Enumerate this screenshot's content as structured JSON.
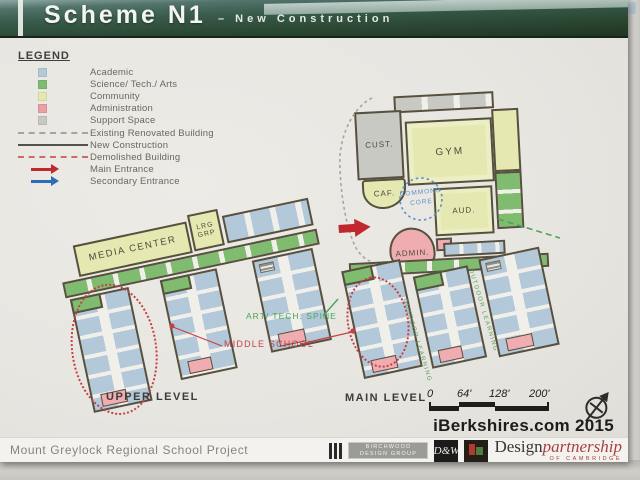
{
  "title": {
    "main": "Scheme N1",
    "subtitle": "– New Construction"
  },
  "legend": {
    "heading": "LEGEND",
    "swatches": [
      {
        "label": "Academic",
        "color": "#b3c9da"
      },
      {
        "label": "Science/ Tech./ Arts",
        "color": "#7fbc70"
      },
      {
        "label": "Community",
        "color": "#e5e8b0"
      },
      {
        "label": "Administration",
        "color": "#e9a0a4"
      },
      {
        "label": "Support Space",
        "color": "#c9c9c3"
      }
    ],
    "lines": [
      {
        "label": "Existing Renovated Building",
        "style": "dashed"
      },
      {
        "label": "New Construction",
        "style": "solid"
      },
      {
        "label": "Demolished Building",
        "style": "dashed"
      }
    ],
    "arrows": [
      {
        "label": "Main Entrance",
        "color": "#c1272d"
      },
      {
        "label": "Secondary Entrance",
        "color": "#2f6db6"
      }
    ]
  },
  "plans": {
    "upper": {
      "caption": "UPPER LEVEL",
      "media_center": "MEDIA CENTER",
      "lrg_grp": "LRG GRP"
    },
    "main": {
      "caption": "MAIN LEVEL",
      "cust": "CUST.",
      "gym": "GYM",
      "caf": "CAF.",
      "commons_line1": "COMMONS",
      "commons_line2": "CORE",
      "aud": "AUD.",
      "admin": "ADMIN.",
      "outdoor_learning": "OUTDOOR LEARNING"
    }
  },
  "annotations": {
    "art_tech_spine": "ART/ TECH. SPINE",
    "middle_school": "MIDDLE SCHOOL"
  },
  "scale_bar": {
    "ticks": [
      "0",
      "64'",
      "128'",
      "200'"
    ]
  },
  "watermark": "iBerkshires.com 2015",
  "footer": {
    "project": "Mount Greylock Regional School Project",
    "birchwood": {
      "line1": "BIRCHWOOD",
      "line2": "DESIGN GROUP"
    },
    "dw_monogram": "D&W",
    "design_partnership": {
      "design": "Design",
      "partnership": "partnership",
      "of": "OF CAMBRIDGE"
    }
  },
  "palette": {
    "academic": "#b3c9da",
    "science": "#7fbc70",
    "community": "#e5e8b0",
    "admin": "#efadb1",
    "support": "#c9c9c3",
    "paper": "#f1efe9",
    "outline": "#57503f",
    "demolish_red": "#c63f44",
    "entrance_red": "#c1272d",
    "secondary_blue": "#2f6db6",
    "spine_green": "#4aa45a",
    "commons_blue": "#5b8fd0",
    "line_gray": "#a5a59d",
    "line_new": "#55524c"
  }
}
